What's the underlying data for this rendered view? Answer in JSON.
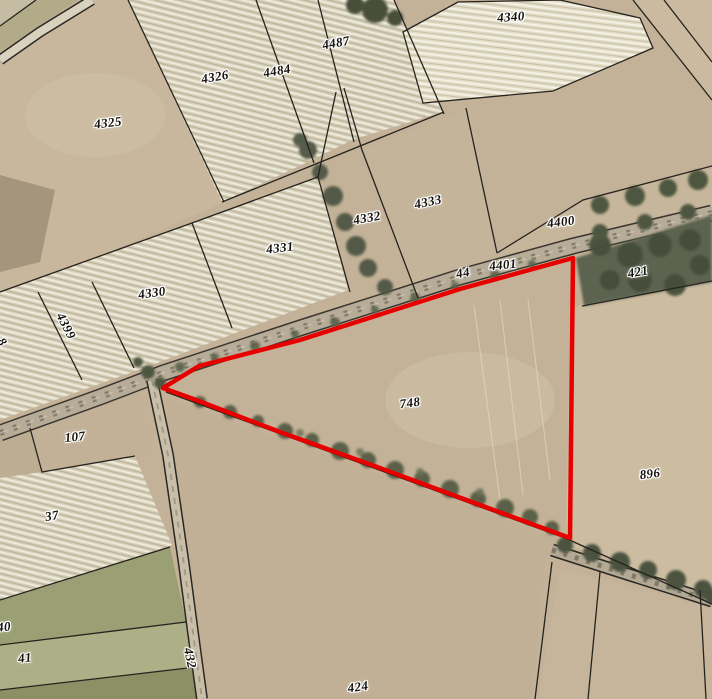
{
  "map": {
    "highlight": {
      "parcel": "748",
      "color": "#e60000"
    },
    "boundary_color": "#26231e",
    "parcels": [
      {
        "label": "4340",
        "x": 511,
        "y": 17,
        "rot": -4
      },
      {
        "label": "4487",
        "x": 336,
        "y": 43,
        "rot": -10
      },
      {
        "label": "4484",
        "x": 277,
        "y": 71,
        "rot": -10
      },
      {
        "label": "4326",
        "x": 215,
        "y": 77,
        "rot": -10
      },
      {
        "label": "4325",
        "x": 108,
        "y": 123,
        "rot": -7
      },
      {
        "label": "4333",
        "x": 428,
        "y": 202,
        "rot": -12
      },
      {
        "label": "4332",
        "x": 367,
        "y": 218,
        "rot": -10
      },
      {
        "label": "4331",
        "x": 280,
        "y": 248,
        "rot": -7
      },
      {
        "label": "4400",
        "x": 561,
        "y": 222,
        "rot": -7
      },
      {
        "label": "4401",
        "x": 503,
        "y": 265,
        "rot": -6
      },
      {
        "label": "44",
        "x": 463,
        "y": 273,
        "rot": -10
      },
      {
        "label": "421",
        "x": 638,
        "y": 272,
        "rot": -10
      },
      {
        "label": "4330",
        "x": 152,
        "y": 293,
        "rot": -8
      },
      {
        "label": "4399",
        "x": 66,
        "y": 326,
        "rot": 63
      },
      {
        "label": "8",
        "x": 2,
        "y": 342,
        "rot": 55
      },
      {
        "label": "748",
        "x": 410,
        "y": 403,
        "rot": -8
      },
      {
        "label": "107",
        "x": 75,
        "y": 437,
        "rot": -6
      },
      {
        "label": "896",
        "x": 650,
        "y": 474,
        "rot": -7
      },
      {
        "label": "37",
        "x": 52,
        "y": 516,
        "rot": -10
      },
      {
        "label": "40",
        "x": 4,
        "y": 627,
        "rot": -5
      },
      {
        "label": "41",
        "x": 25,
        "y": 658,
        "rot": -7
      },
      {
        "label": "432",
        "x": 190,
        "y": 658,
        "rot": 78
      },
      {
        "label": "424",
        "x": 358,
        "y": 687,
        "rot": -8
      }
    ]
  }
}
